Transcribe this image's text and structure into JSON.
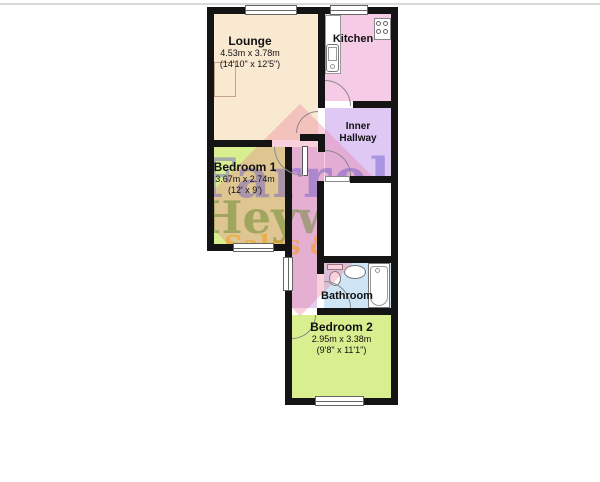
{
  "page": {
    "top_rule_color": "#d9d9d9",
    "background": "#ffffff"
  },
  "rooms": {
    "lounge": {
      "name": "Lounge",
      "dim_metric": "4.53m x 3.78m",
      "dim_imperial": "(14'10\" x 12'5\")",
      "fill": "#F9E9D1"
    },
    "kitchen": {
      "name": "Kitchen",
      "fill": "#F6CBE6"
    },
    "inner_hallway": {
      "name_line1": "Inner",
      "name_line2": "Hallway",
      "fill": "#DFC8F4"
    },
    "bedroom1": {
      "name": "Bedroom 1",
      "dim_metric": "3.67m x 2.74m",
      "dim_imperial": "(12' x 9')",
      "fill": "#D9EE8F"
    },
    "bathroom": {
      "name": "Bathroom",
      "fill": "#CFE5F5"
    },
    "bedroom2": {
      "name": "Bedroom 2",
      "dim_metric": "2.95m x 3.38m",
      "dim_imperial": "(9'8\" x 11'1\")",
      "fill": "#D9EE8F"
    },
    "corridor": {
      "fill": "#E3CCF0"
    }
  },
  "colors": {
    "wall": "#141414",
    "door_arc": "#8a8a8a",
    "window_border": "#666666"
  },
  "watermark": {
    "line1": "Farrell",
    "line2": "Heywood",
    "line3_part1": "Sales & ",
    "line3_part2": "Le",
    "diamond_color": "rgba(233,116,150,0.33)",
    "line1_color": "rgba(95,80,200,0.42)",
    "line2_color": "rgba(100,135,45,0.5)",
    "line3_color": "rgba(240,160,25,0.6)",
    "line3_part2_color": "rgba(195,125,215,0.65)"
  },
  "fixtures": {
    "kitchen_counter": "kitchen counter",
    "kitchen_sink": "kitchen sink",
    "hob": "4-ring hob",
    "alcove": "alcove recess",
    "toilet": "toilet",
    "basin": "wash basin",
    "bathtub": "bathtub"
  }
}
